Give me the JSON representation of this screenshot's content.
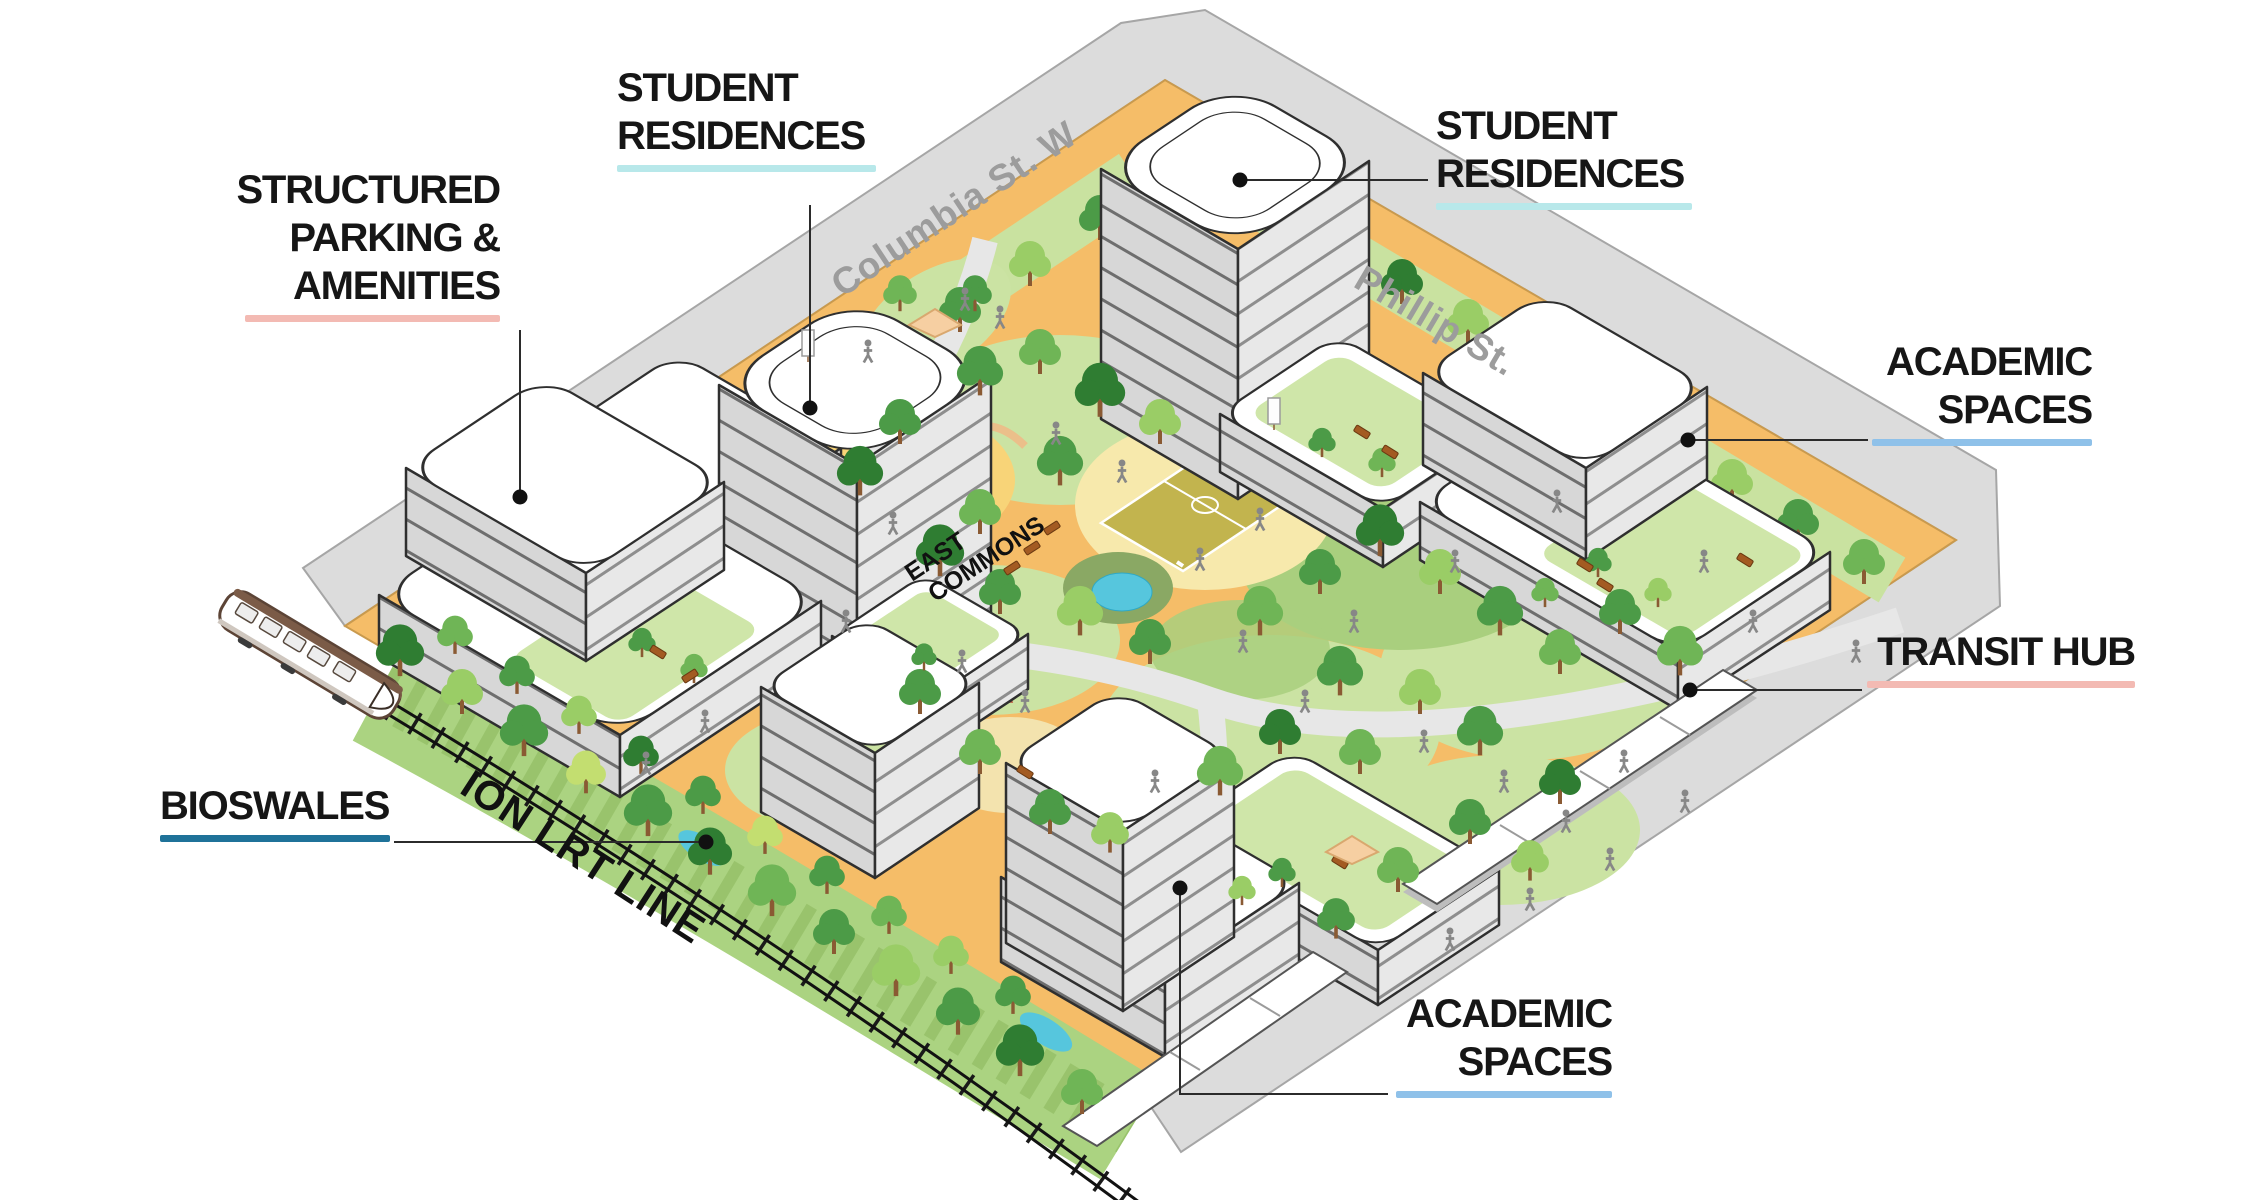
{
  "diagram_title": "Campus master plan isometric diagram",
  "callouts": {
    "student_residences_left": {
      "lines": [
        "STUDENT",
        "RESIDENCES"
      ],
      "underline_color": "#B8E8EA"
    },
    "student_residences_right": {
      "lines": [
        "STUDENT",
        "RESIDENCES"
      ],
      "underline_color": "#B8E8EA"
    },
    "structured_parking": {
      "lines": [
        "STRUCTURED",
        "PARKING &",
        "AMENITIES"
      ],
      "underline_color": "#F3BAB3"
    },
    "academic_spaces_right": {
      "lines": [
        "ACADEMIC",
        "SPACES"
      ],
      "underline_color": "#8FC1E9"
    },
    "transit_hub": {
      "lines": [
        "TRANSIT HUB"
      ],
      "underline_color": "#F3BAB3"
    },
    "bioswales": {
      "lines": [
        "BIOSWALES"
      ],
      "underline_color": "#1F7299"
    },
    "academic_spaces_bottom": {
      "lines": [
        "ACADEMIC",
        "SPACES"
      ],
      "underline_color": "#8FC1E9"
    }
  },
  "map_texts": {
    "street_1": "Columbia St. W",
    "street_2": "Phillip St.",
    "rail_line": "ION LRT LINE",
    "park_line1": "EAST",
    "park_line2": "COMMONS"
  },
  "palette": {
    "street_gray": "#DCDCDC",
    "path_orange": "#F5BD68",
    "plaza_yellow": "#F8D478",
    "lawn_green": "#CBE3A3",
    "meadow_green": "#A9CF7E",
    "bioswale_green": "#ABD381",
    "pond_teal": "#56C6DD",
    "court_olive": "#C2B44E",
    "building_face": "#D7D7D7",
    "label_text": "#161616",
    "street_label_gray": "#9C9C9C",
    "train_brown": "#7B5B47"
  }
}
